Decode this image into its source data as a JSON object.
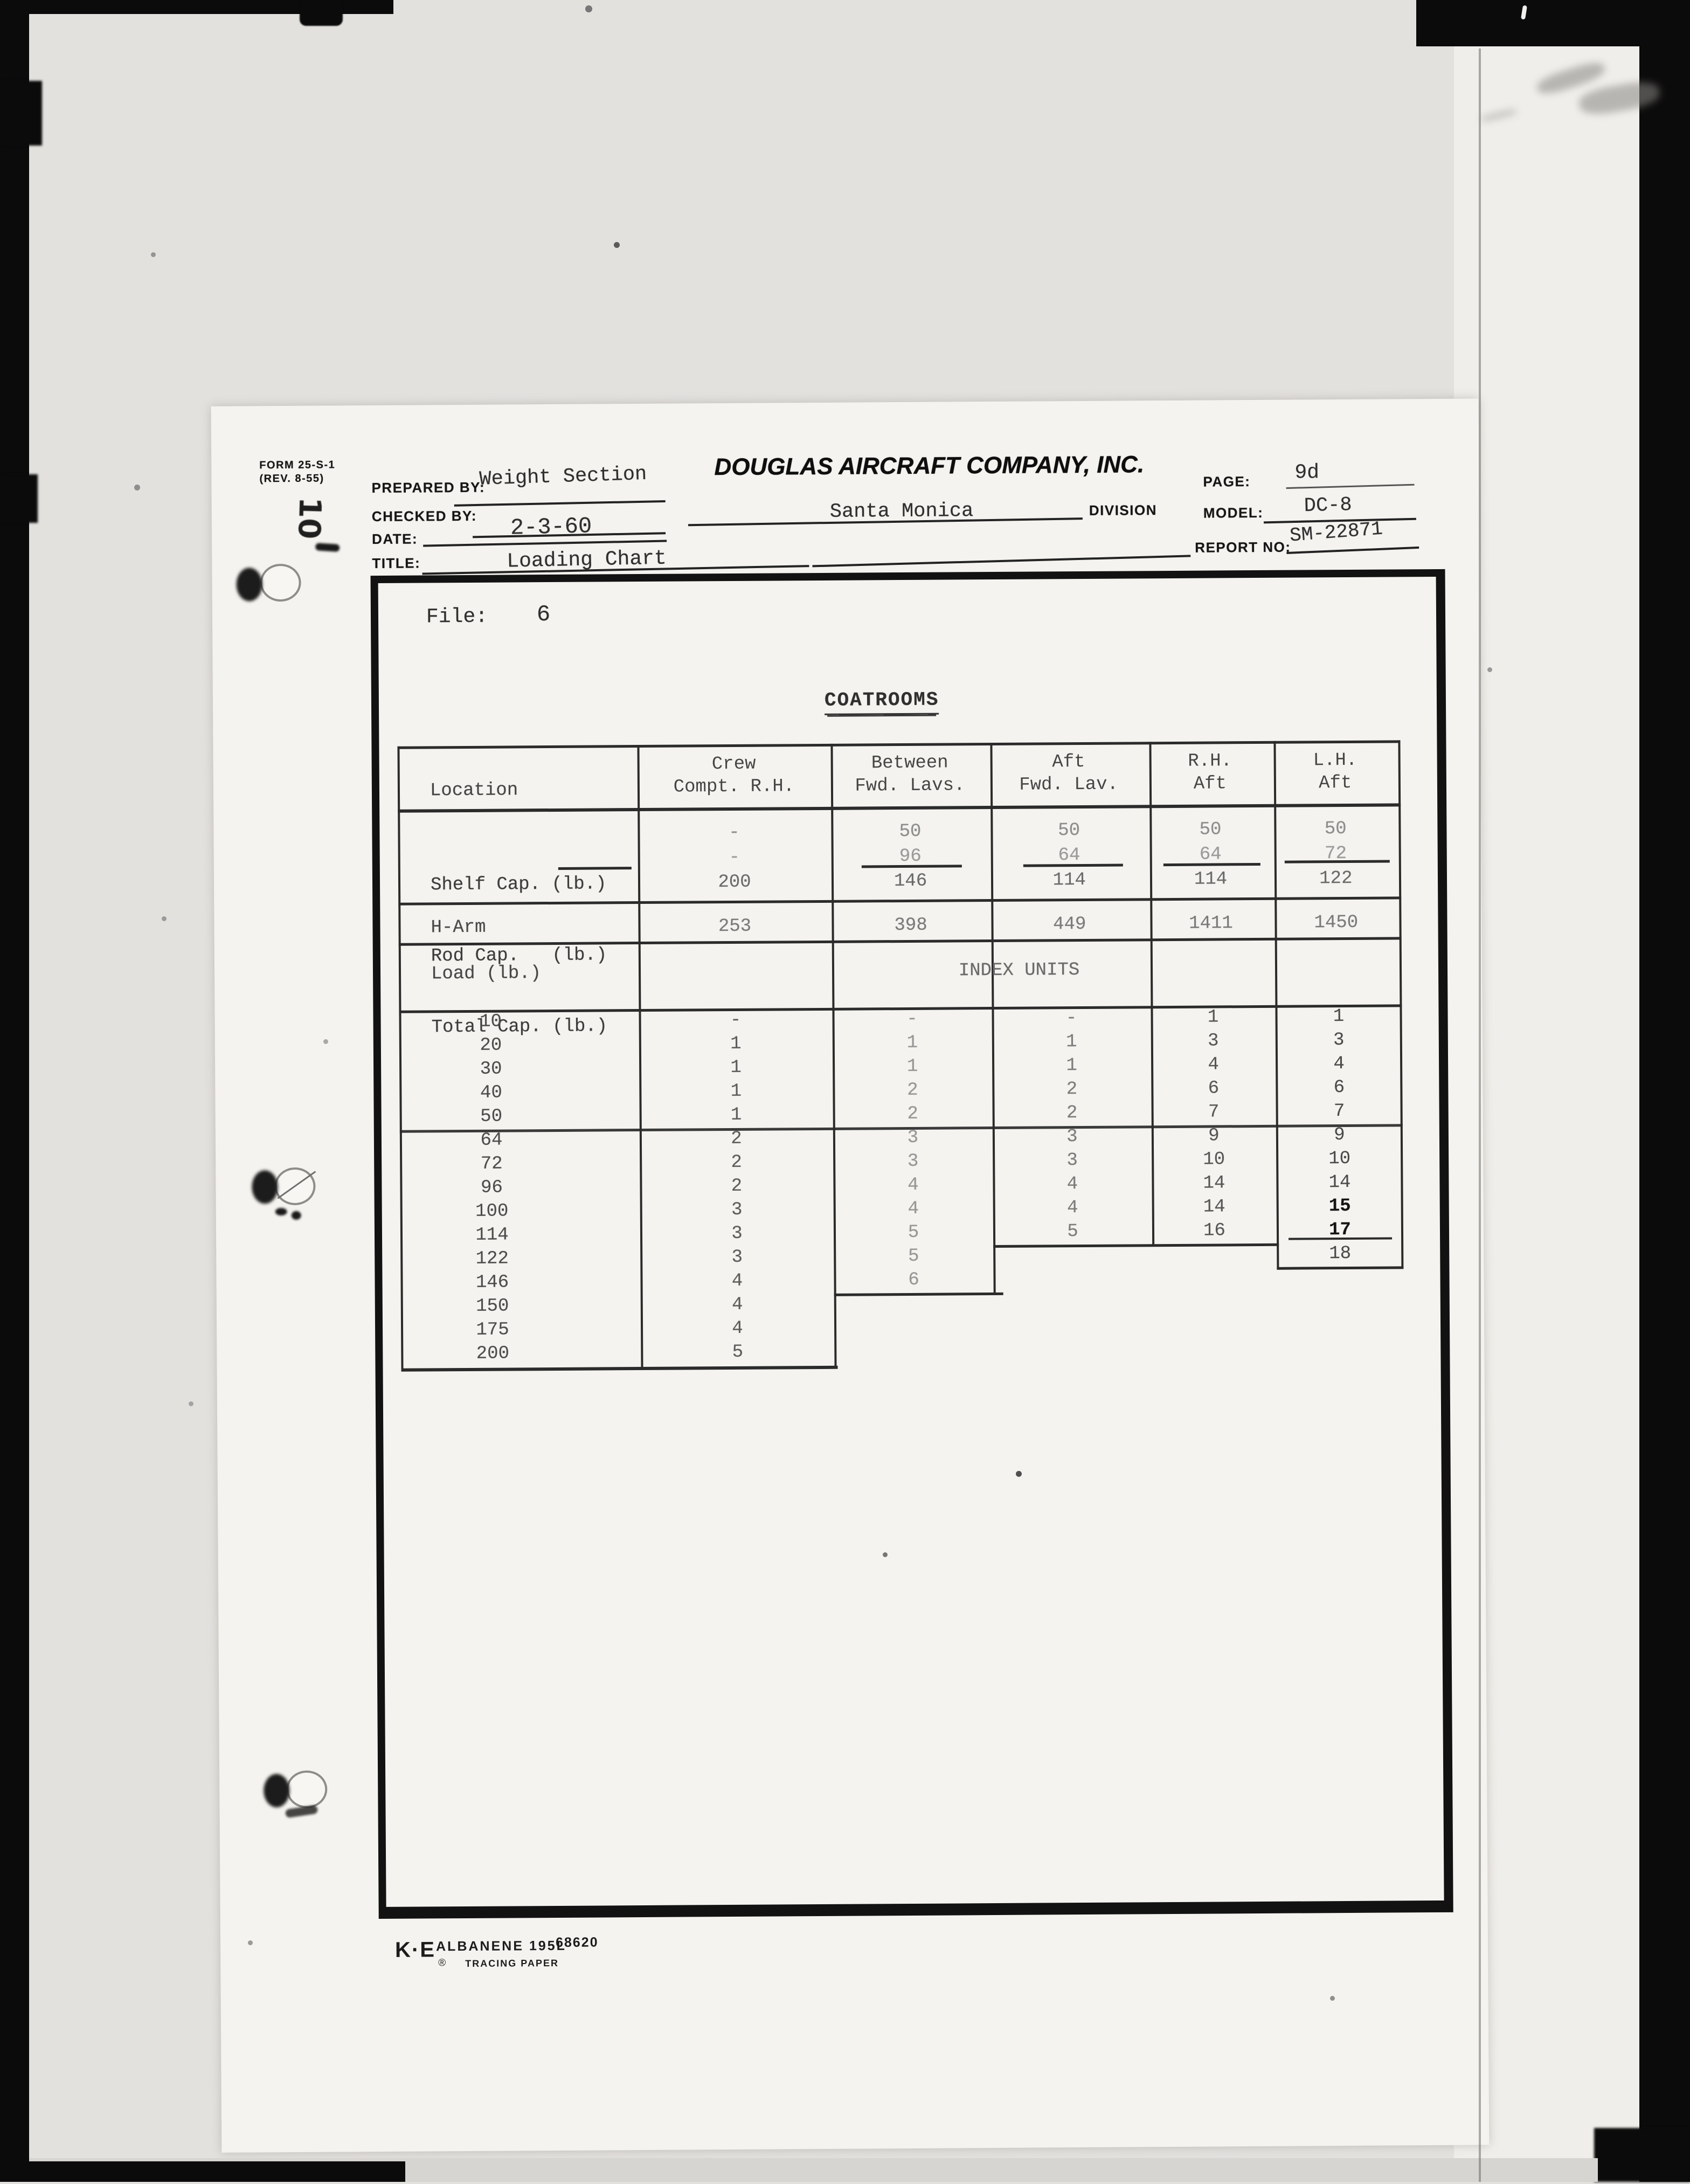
{
  "scan": {
    "margin_note": "10"
  },
  "header": {
    "form_line1": "FORM 25-S-1",
    "form_line2": "(REV. 8-55)",
    "prepared_by_label": "PREPARED BY:",
    "prepared_by_value": "Weight Section",
    "checked_by_label": "CHECKED BY:",
    "date_label": "DATE:",
    "date_value": "2-3-60",
    "title_label": "TITLE:",
    "title_value": "Loading Chart",
    "company_name": "DOUGLAS AIRCRAFT COMPANY, INC.",
    "division_value": "Santa Monica",
    "division_label": "DIVISION",
    "page_label": "PAGE:",
    "page_value": "9d",
    "model_label": "MODEL:",
    "model_value": "DC-8",
    "report_no_label": "REPORT NO:",
    "report_no_value": "SM-22871"
  },
  "file": {
    "label": "File:",
    "number": "6"
  },
  "table": {
    "title": "COATROOMS",
    "location_header": "Location",
    "columns": [
      {
        "label1": "Crew",
        "label2": "Compt. R.H."
      },
      {
        "label1": "Between",
        "label2": "Fwd. Lavs."
      },
      {
        "label1": "Aft",
        "label2": "Fwd. Lav."
      },
      {
        "label1": "R.H.",
        "label2": "Aft"
      },
      {
        "label1": "L.H.",
        "label2": "Aft"
      }
    ],
    "shelf_label": "Shelf Cap. (lb.)",
    "rod_label": "Rod Cap.   (lb.)",
    "total_label": "Total Cap. (lb.)",
    "shelf_values": [
      "-",
      "50",
      "50",
      "50",
      "50"
    ],
    "rod_values": [
      "-",
      "96",
      "64",
      "64",
      "72"
    ],
    "total_values": [
      "200",
      "146",
      "114",
      "114",
      "122"
    ],
    "harm_label": "H-Arm",
    "harm_values": [
      "253",
      "398",
      "449",
      "1411",
      "1450"
    ],
    "load_header": "Load (lb.)",
    "index_header": "INDEX UNITS",
    "loads": [
      "10",
      "20",
      "30",
      "40",
      "50",
      "64",
      "72",
      "96",
      "100",
      "114",
      "122",
      "146",
      "150",
      "175",
      "200"
    ],
    "index_crew": [
      "-",
      "1",
      "1",
      "1",
      "1",
      "2",
      "2",
      "2",
      "3",
      "3",
      "3",
      "4",
      "4",
      "4",
      "5"
    ],
    "index_between": [
      "-",
      "1",
      "1",
      "2",
      "2",
      "3",
      "3",
      "4",
      "4",
      "5",
      "5",
      "6"
    ],
    "index_aft": [
      "-",
      "1",
      "1",
      "2",
      "2",
      "3",
      "3",
      "4",
      "4",
      "5"
    ],
    "index_rh_aft": [
      "1",
      "3",
      "4",
      "6",
      "7",
      "9",
      "10",
      "14",
      "14",
      "16"
    ],
    "index_lh_aft": [
      "1",
      "3",
      "4",
      "6",
      "7",
      "9",
      "10",
      "14",
      "15",
      "17",
      "18"
    ]
  },
  "footer": {
    "logo": "K·E",
    "product": "ALBANENE 195L",
    "registered": "®",
    "subtitle": "TRACING PAPER",
    "stock_number": "68620"
  }
}
